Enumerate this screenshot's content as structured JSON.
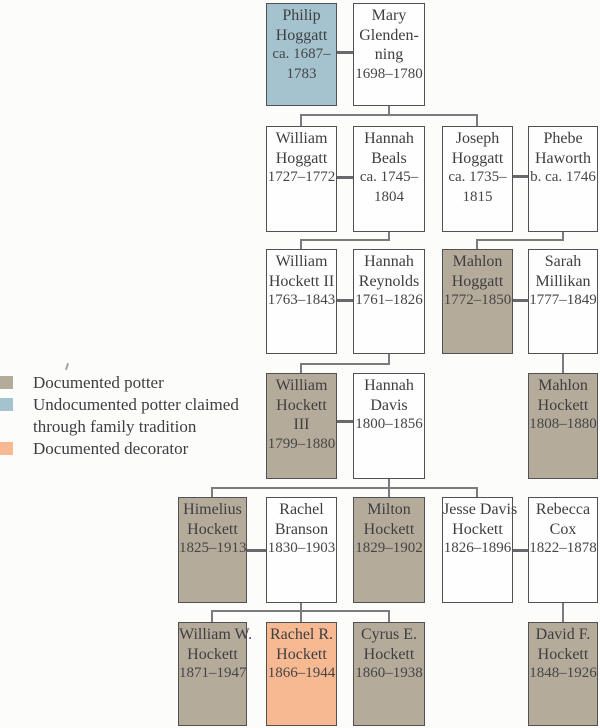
{
  "diagram": {
    "type": "family-tree",
    "subject": "Hoggatt / Hockett potter family genealogy"
  },
  "colors": {
    "documented_potter": "#b5ab9b",
    "undocumented_potter": "#a5c3cf",
    "documented_decorator": "#f7b992",
    "box_border": "#515154",
    "connector_line": "#7a7b7e",
    "marriage_line": "#68696c",
    "text": "#3e3e40",
    "background": "#fcfcfb"
  },
  "legend": {
    "items": [
      {
        "label": "Documented potter",
        "color": "#b5ab9b",
        "swatch": "potter"
      },
      {
        "label": "Undocumented potter claimed\nthrough family tradition",
        "color": "#a5c3cf",
        "swatch": "undoc"
      },
      {
        "label": "Documented decorator",
        "color": "#f7b992",
        "swatch": "decorator"
      }
    ]
  },
  "people": [
    {
      "name": "Philip\nHoggatt",
      "dates": "ca. 1687–\n1783",
      "status": "undocumented-potter"
    },
    {
      "name": "Mary\nGlenden-\nning",
      "dates": "1698–1780",
      "status": "none"
    },
    {
      "name": "William\nHoggatt",
      "dates": "1727–1772",
      "status": "none"
    },
    {
      "name": "Hannah\nBeals",
      "dates": "ca. 1745–\n1804",
      "status": "none"
    },
    {
      "name": "Joseph\nHoggatt",
      "dates": "ca. 1735–\n1815",
      "status": "none"
    },
    {
      "name": "Phebe\nHaworth",
      "dates": "b. ca. 1746",
      "status": "none"
    },
    {
      "name": "William\nHockett II",
      "dates": "1763–1843",
      "status": "none"
    },
    {
      "name": "Hannah\nReynolds",
      "dates": "1761–1826",
      "status": "none"
    },
    {
      "name": "Mahlon\nHoggatt",
      "dates": "1772–1850",
      "status": "documented-potter"
    },
    {
      "name": "Sarah\nMillikan",
      "dates": "1777–1849",
      "status": "none"
    },
    {
      "name": "William\nHockett\nIII",
      "dates": "1799–1880",
      "status": "documented-potter"
    },
    {
      "name": "Hannah\nDavis",
      "dates": "1800–1856",
      "status": "none"
    },
    {
      "name": "Mahlon\nHockett",
      "dates": "1808–1880",
      "status": "documented-potter"
    },
    {
      "name": "Himelius\nHockett",
      "dates": "1825–1913",
      "status": "documented-potter"
    },
    {
      "name": "Rachel\nBranson",
      "dates": "1830–1903",
      "status": "none"
    },
    {
      "name": "Milton\nHockett",
      "dates": "1829–1902",
      "status": "documented-potter"
    },
    {
      "name": "Jesse Davis\nHockett",
      "dates": "1826–1896",
      "status": "none"
    },
    {
      "name": "Rebecca\nCox",
      "dates": "1822–1878",
      "status": "none"
    },
    {
      "name": "William W.\nHockett",
      "dates": "1871–1947",
      "status": "documented-potter"
    },
    {
      "name": "Rachel R.\nHockett",
      "dates": "1866–1944",
      "status": "documented-decorator"
    },
    {
      "name": "Cyrus E.\nHockett",
      "dates": "1860–1938",
      "status": "documented-potter"
    },
    {
      "name": "David F.\nHockett",
      "dates": "1848–1926",
      "status": "documented-potter"
    }
  ]
}
